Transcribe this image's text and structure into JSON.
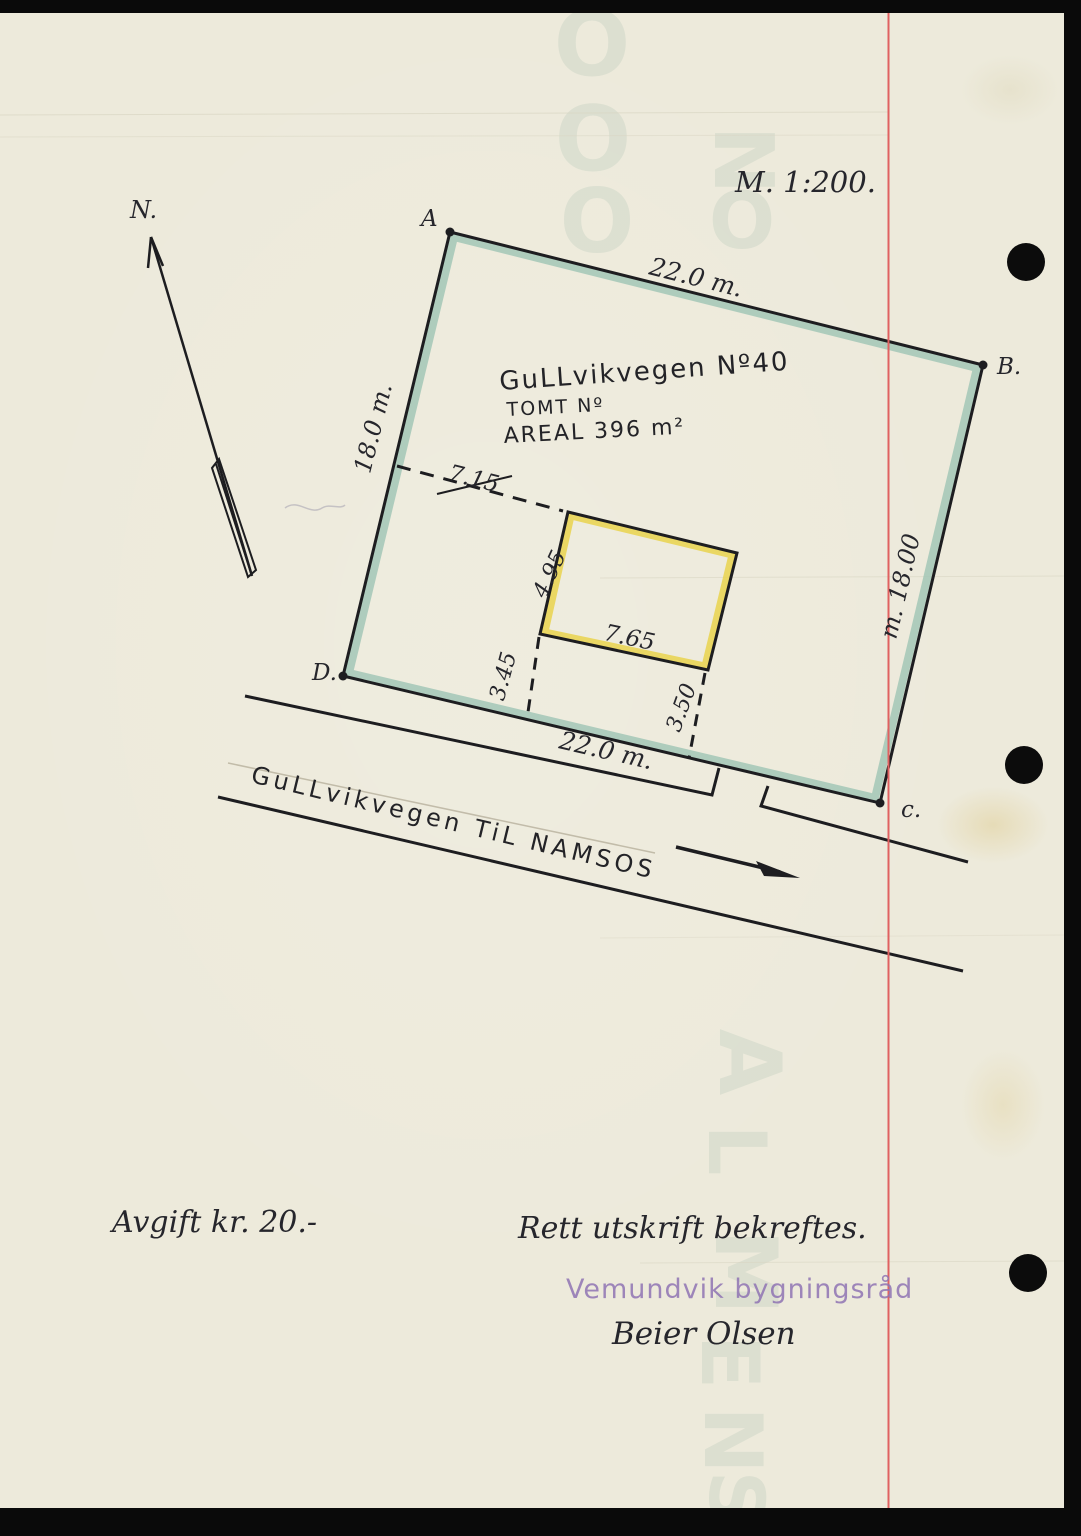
{
  "document": {
    "scale_label": "M. 1:200.",
    "north": {
      "label": "N."
    },
    "parcel": {
      "corner_a": "A",
      "corner_b": "B.",
      "corner_c": "c.",
      "corner_d": "D.",
      "street_label": "GuLLvikvegen Nº40",
      "lot_label": "TOMT Nº",
      "area_label": "AREAL 396 m²",
      "side_top": "22.0 m.",
      "side_left": "18.0 m.",
      "side_right": "m. 18.00",
      "side_bottom": "22.0 m."
    },
    "building": {
      "side_dim": "4.95",
      "front_dim": "7.65"
    },
    "setbacks": {
      "west": "7.15",
      "south_left": "3.45",
      "south_right": "3.50"
    },
    "road": {
      "name": "GuLLvikvegen TiL NAMSOS"
    },
    "footer": {
      "fee_note": "Avgift kr. 20.-",
      "certify_note": "Rett utskrift bekreftes.",
      "stamp": "Vemundvik bygningsråd",
      "signature": "Beier Olsen"
    },
    "watermark": {
      "letters": [
        "O",
        "O",
        "O",
        "N",
        "O",
        "A",
        "L",
        "M",
        "E",
        "N",
        "S"
      ]
    },
    "colors": {
      "paper": "#edeadb",
      "ink": "#1d1d20",
      "boundary_shade": "#9dc4b4",
      "building_shade": "#e9d44e",
      "margin_line": "#e06161",
      "stamp_ink": "#8f74b3"
    }
  }
}
